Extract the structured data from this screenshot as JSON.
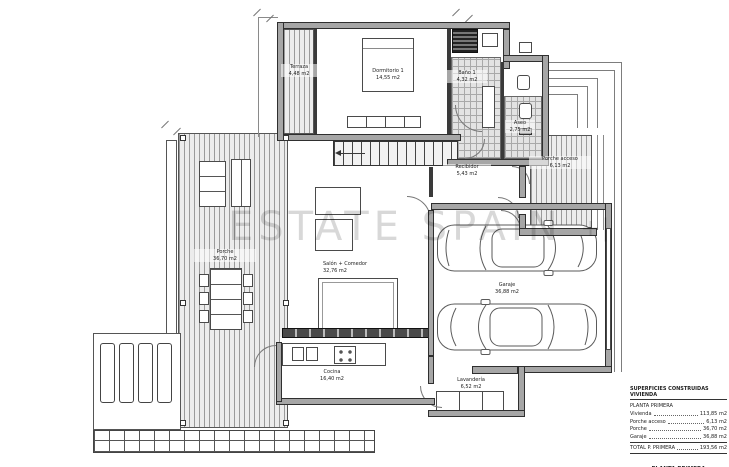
{
  "watermark": {
    "text": "ESTATE SPAIN",
    "mark": "+|"
  },
  "rooms": {
    "terraza": {
      "name": "Terraza",
      "area": "4,48 m2"
    },
    "dormitorio": {
      "name": "Dormitorio 1",
      "area": "14,55 m2"
    },
    "bano": {
      "name": "Baño 1",
      "area": "4,32 m2"
    },
    "aseo": {
      "name": "Aseo",
      "area": "2,75 m2"
    },
    "recibidor": {
      "name": "Recibidor",
      "area": "5,43 m2"
    },
    "salon": {
      "name": "Salón + Comedor",
      "area": "32,76 m2"
    },
    "porche": {
      "name": "Porche",
      "area": "36,70 m2"
    },
    "porche_acceso": {
      "name": "Porche acceso",
      "area": "6,13 m2"
    },
    "garaje": {
      "name": "Garaje",
      "area": "36,88 m2"
    },
    "cocina": {
      "name": "Cocina",
      "area": "16,40 m2"
    },
    "lavanderia": {
      "name": "Lavandería",
      "area": "6,52 m2"
    }
  },
  "legend": {
    "header": "SUPERFICIES CONSTRUIDAS VIVIENDA",
    "section": "PLANTA PRIMERA",
    "rows": [
      {
        "label": "Vivienda",
        "value": "113,85 m2"
      },
      {
        "label": "Porche acceso",
        "value": "6,13 m2"
      },
      {
        "label": "Porche",
        "value": "36,70 m2"
      },
      {
        "label": "Garaje",
        "value": "36,88 m2"
      }
    ],
    "total": {
      "label": "TOTAL P. PRIMERA",
      "value": "193,56 m2"
    },
    "plan_title": "PLANTA PRIMERA",
    "scale": "ESCALA 1/50"
  },
  "colors": {
    "wall": "#a6a6a6",
    "line": "#2f2f2f",
    "tile": "#e3e3e3",
    "watermark": "#c9c9c9"
  }
}
